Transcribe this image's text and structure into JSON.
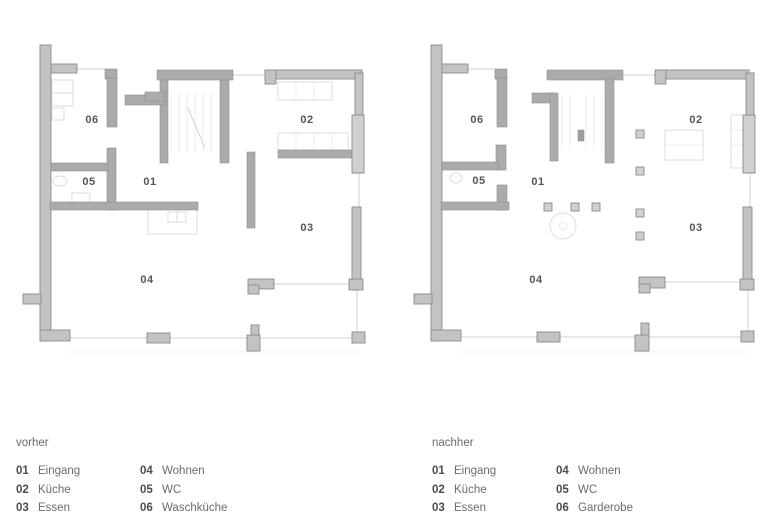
{
  "plans": {
    "before": {
      "room_labels": {
        "r01": "01",
        "r02": "02",
        "r03": "03",
        "r04": "04",
        "r05": "05",
        "r06": "06"
      }
    },
    "after": {
      "room_labels": {
        "r01": "01",
        "r02": "02",
        "r03": "03",
        "r04": "04",
        "r05": "05",
        "r06": "06"
      }
    }
  },
  "legends": {
    "before": {
      "title": "vorher",
      "items": [
        {
          "num": "01",
          "label": "Eingang"
        },
        {
          "num": "02",
          "label": "Küche"
        },
        {
          "num": "03",
          "label": "Essen"
        },
        {
          "num": "04",
          "label": "Wohnen"
        },
        {
          "num": "05",
          "label": "WC"
        },
        {
          "num": "06",
          "label": "Waschküche"
        }
      ]
    },
    "after": {
      "title": "nachher",
      "items": [
        {
          "num": "01",
          "label": "Eingang"
        },
        {
          "num": "02",
          "label": "Küche"
        },
        {
          "num": "03",
          "label": "Essen"
        },
        {
          "num": "04",
          "label": "Wohnen"
        },
        {
          "num": "05",
          "label": "WC"
        },
        {
          "num": "06",
          "label": "Garderobe"
        }
      ]
    }
  },
  "colors": {
    "wall": "#c3c3c3",
    "wall_outline": "#8c8c8c",
    "text": "#565656"
  }
}
